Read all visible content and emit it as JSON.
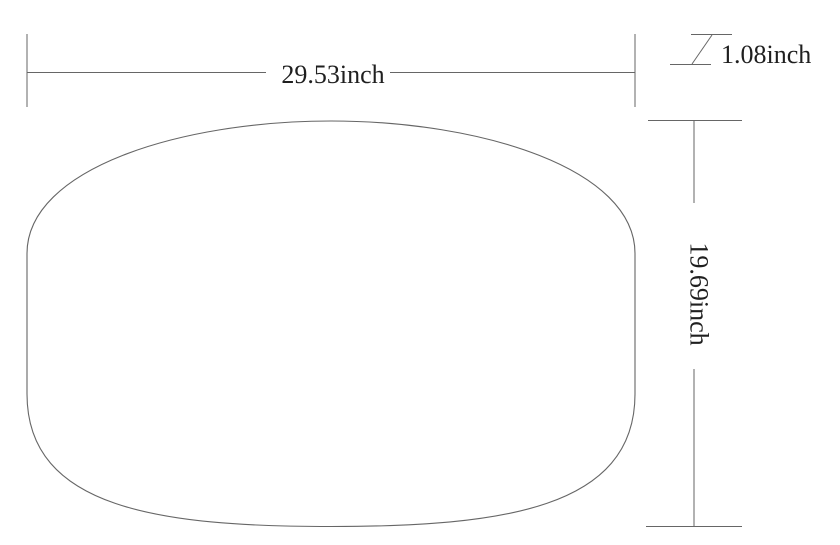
{
  "drawing": {
    "type": "technical-dimension-drawing",
    "shape": "rounded rectangular platter outline"
  },
  "dimensions": {
    "width": {
      "label": "29.53inch"
    },
    "thickness": {
      "label": "1.08inch"
    },
    "height": {
      "label": "19.69inch"
    }
  },
  "colors": {
    "line": "#666666",
    "text": "#1f1f1f",
    "background": "#ffffff"
  }
}
